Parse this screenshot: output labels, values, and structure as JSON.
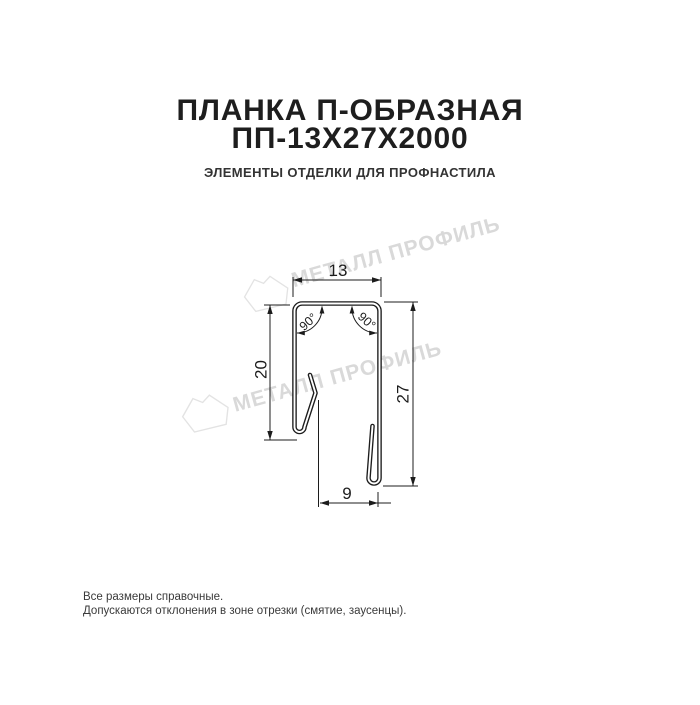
{
  "header": {
    "title_line1": "ПЛАНКА П-ОБРАЗНАЯ",
    "title_line2": "ПП-13Х27Х2000",
    "subtitle": "ЭЛЕМЕНТЫ ОТДЕЛКИ ДЛЯ ПРОФНАСТИЛА"
  },
  "drawing": {
    "type": "profile-cross-section",
    "dimensions": {
      "top_width": "13",
      "left_height": "20",
      "right_height": "27",
      "bottom_width": "9",
      "angle_left": "90°",
      "angle_right": "90°"
    },
    "line_color": "#1c1c1c",
    "watermark": {
      "text": "МЕТАЛЛ ПРОФИЛЬ",
      "color": "#d9d9d9",
      "logo_stroke": "#e3e3e3"
    }
  },
  "footer": {
    "line1": "Все размеры справочные.",
    "line2": "Допускаются отклонения в зоне отрезки (смятие, заусенцы)."
  }
}
